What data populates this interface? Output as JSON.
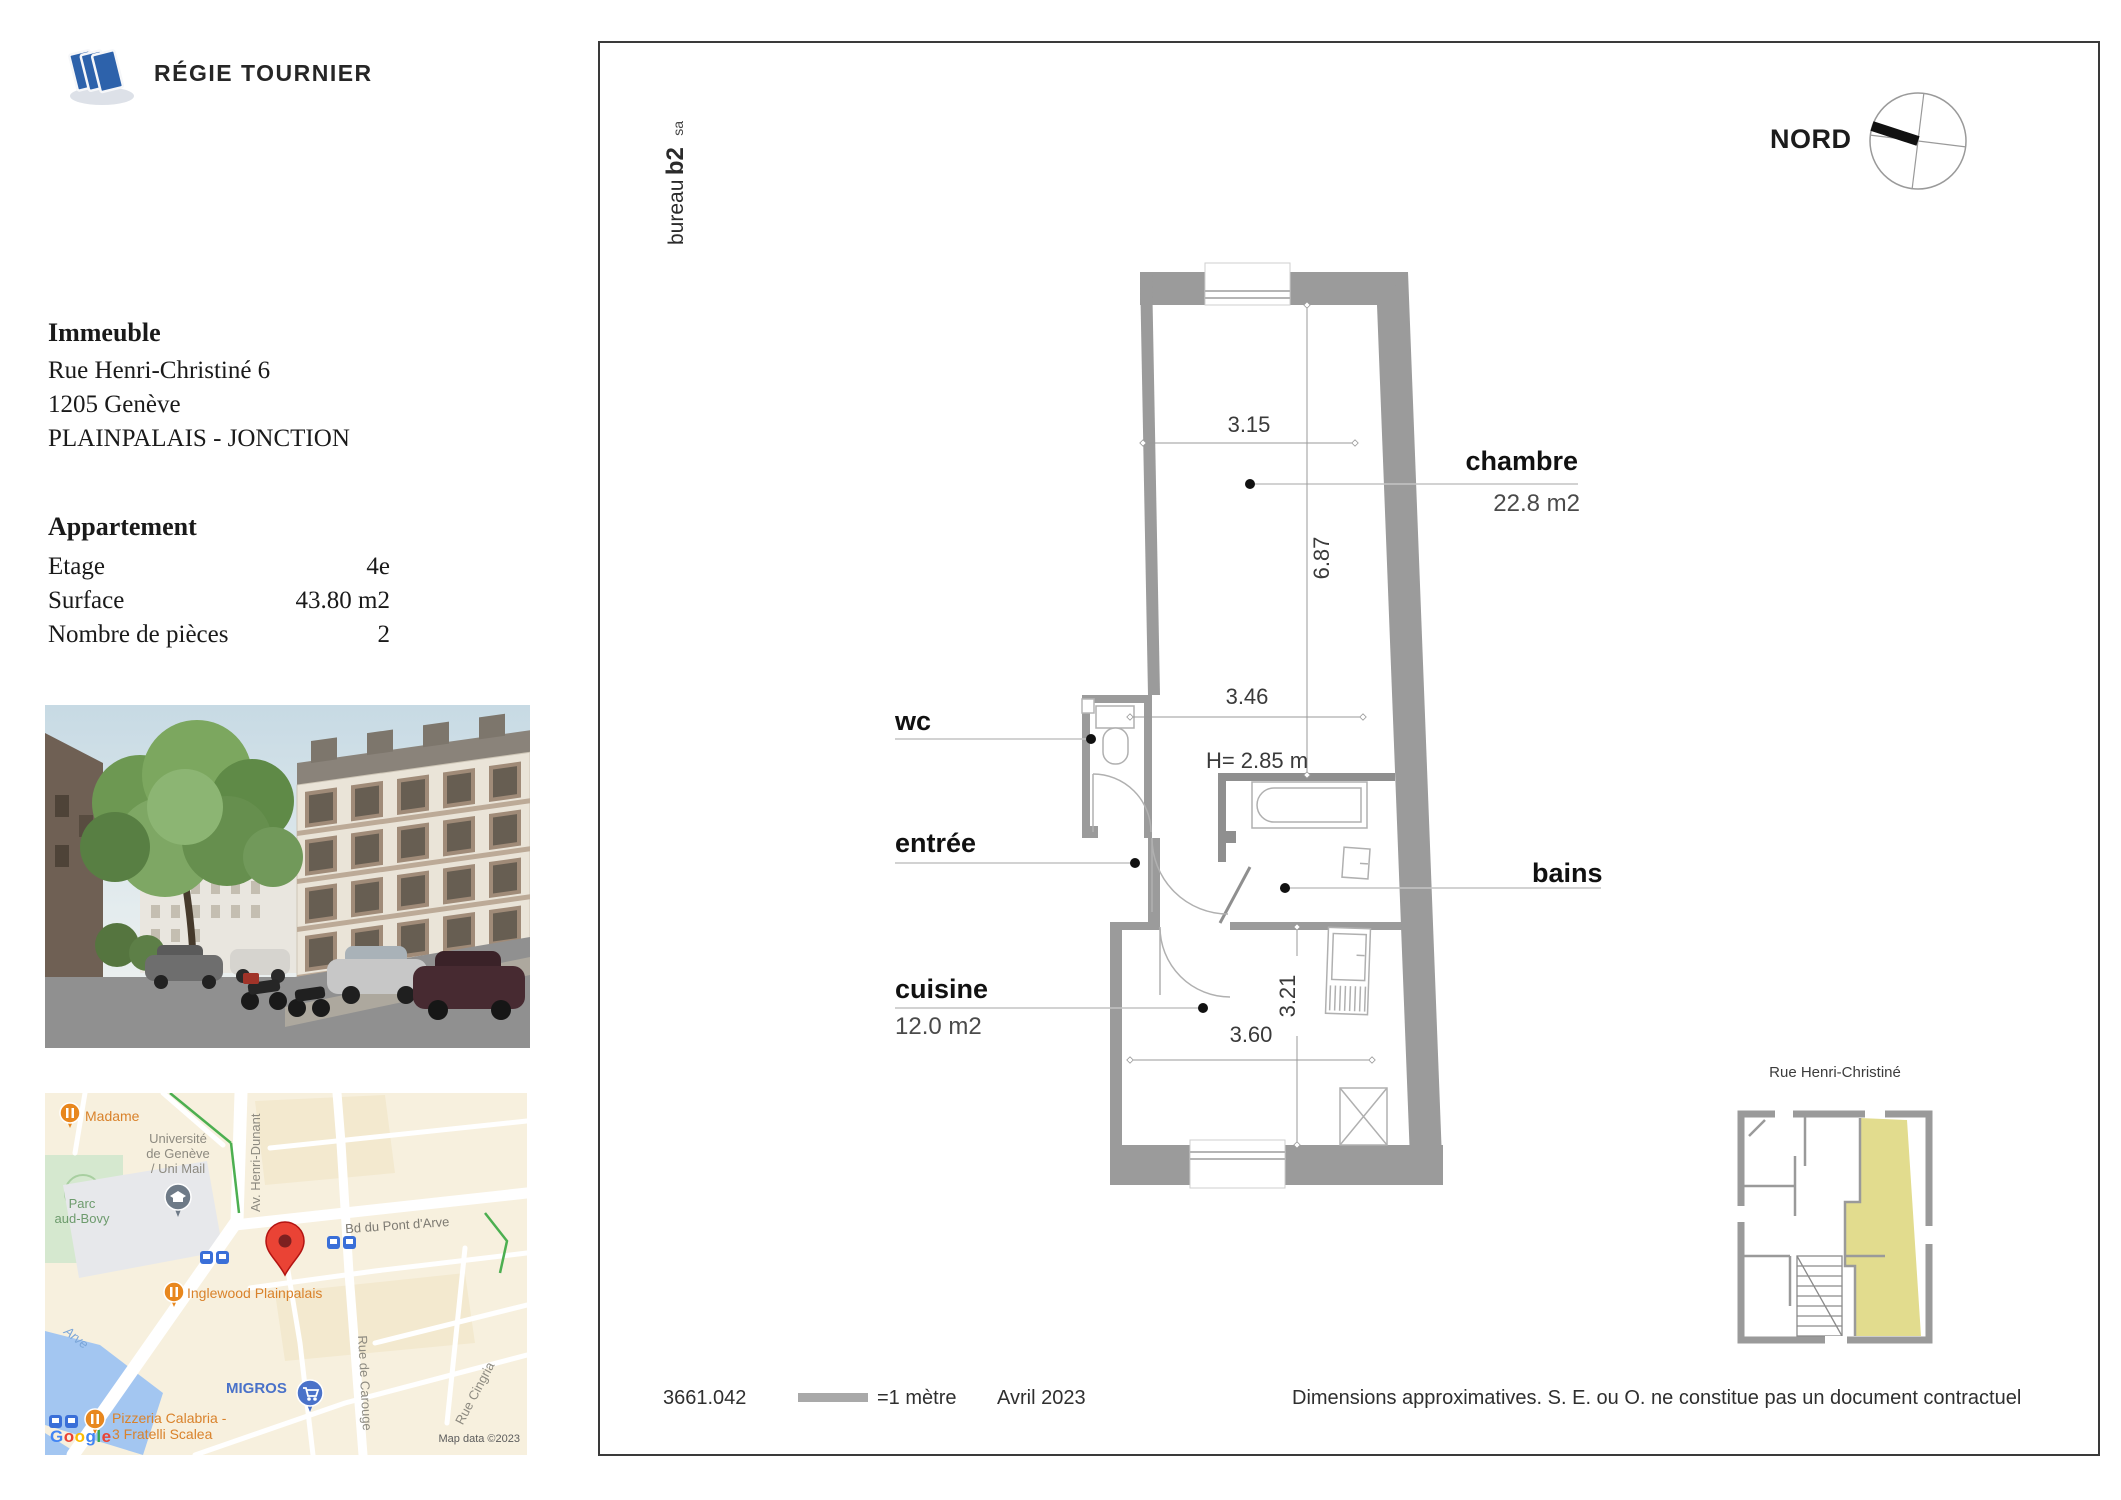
{
  "branding": {
    "company": "RÉGIE TOURNIER",
    "bureau": "bureau",
    "b2": "b2",
    "sa": "sa"
  },
  "immeuble": {
    "title": "Immeuble",
    "address": "Rue Henri-Christiné 6",
    "city": "1205 Genève",
    "district": "PLAINPALAIS - JONCTION"
  },
  "appartement": {
    "title": "Appartement",
    "rows": [
      {
        "label": "Etage",
        "value": "4e"
      },
      {
        "label": "Surface",
        "value": "43.80 m2"
      },
      {
        "label": "Nombre de pièces",
        "value": "2"
      }
    ]
  },
  "compass": {
    "label": "NORD"
  },
  "plan": {
    "rooms": {
      "chambre": {
        "name": "chambre",
        "area": "22.8 m2"
      },
      "wc": {
        "name": "wc"
      },
      "entree": {
        "name": "entrée"
      },
      "bains": {
        "name": "bains"
      },
      "cuisine": {
        "name": "cuisine",
        "area": "12.0 m2"
      }
    },
    "dimensions": {
      "chambre_width": "3.15",
      "chambre_length": "6.87",
      "hall_width": "3.46",
      "ceiling_height": "H= 2.85 m",
      "cuisine_depth": "3.21",
      "cuisine_width": "3.60"
    }
  },
  "mini_plan": {
    "street": "Rue Henri-Christiné"
  },
  "footer": {
    "reference": "3661.042",
    "scale": "=1 mètre",
    "date": "Avril 2023",
    "disclaimer": "Dimensions approximatives. S. E. ou O. ne constitue pas un document contractuel"
  },
  "map": {
    "poi_madame": "Madame",
    "university": "Université\nde Genève\n/ Uni Mail",
    "parc": "Parc\naud-Bovy",
    "av_henri_dunant": "Av. Henri-Dunant",
    "bd_pont_arve": "Bd du Pont d'Arve",
    "inglewood": "Inglewood Plainpalais",
    "arve": "Arve",
    "migros": "MIGROS",
    "pizzeria": "Pizzeria Calabria -\n3 Fratelli Scalea",
    "rue_carouge": "Rue de Carouge",
    "rue_cingria": "Rue Cingria",
    "attribution": "Map data ©2023",
    "google": {
      "g1": "G",
      "o1": "o",
      "o2": "o",
      "g2": "g",
      "l": "l",
      "e": "e"
    }
  },
  "colors": {
    "wall": "#9b9b9b",
    "highlight": "#e2dc8e",
    "accent_blue": "#2d62ab",
    "pin_red": "#ea4335"
  }
}
